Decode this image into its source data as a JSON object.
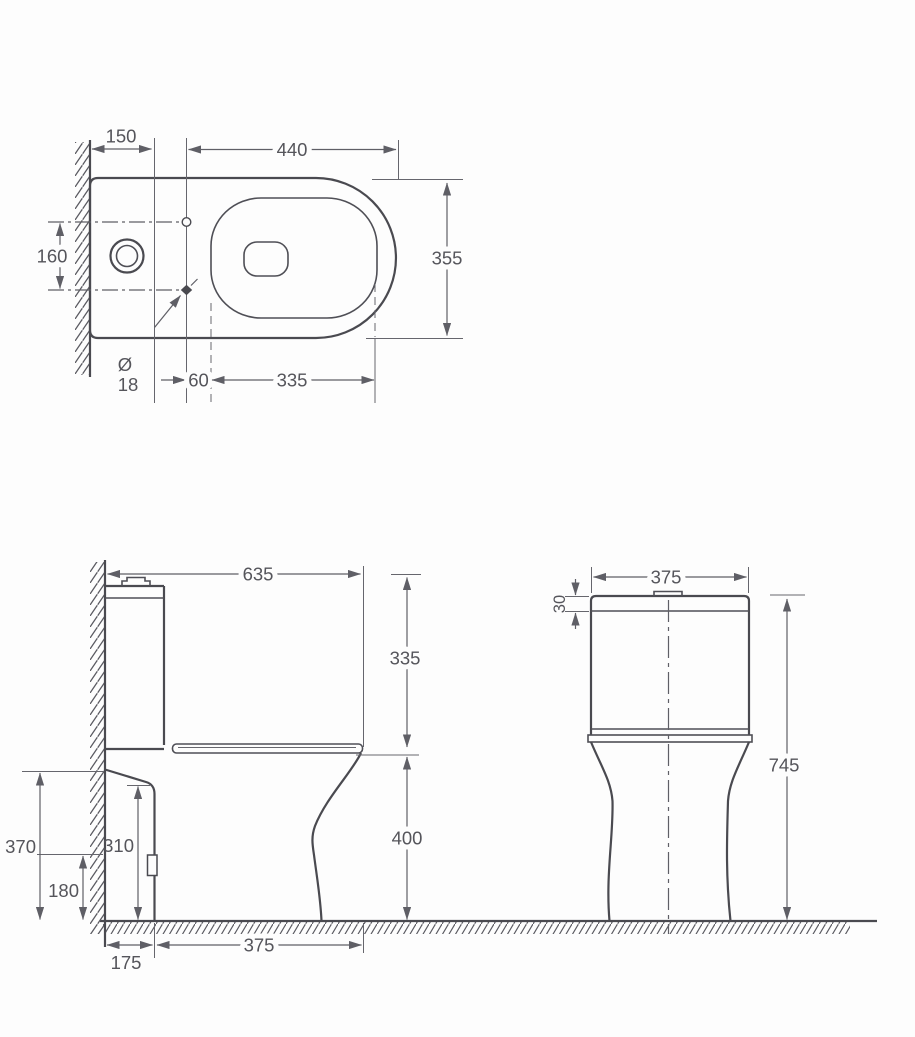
{
  "drawing_type": "toilet-technical-dimension-drawing",
  "colors": {
    "background": "#fdfdfd",
    "outline": "#4a4a50",
    "dimension": "#5f5f66",
    "text": "#55555b"
  },
  "dims": {
    "wall_to_holes": "150",
    "rim_length": "440",
    "rim_width": "355",
    "inlet_centres": "160",
    "hole_symbol": "Ø",
    "hole_size": "18",
    "holes_to_opening": "60",
    "opening_length": "335",
    "overall_depth": "635",
    "cistern_above_seat": "335",
    "seat_height": "400",
    "back_height": "370",
    "fixing_height": "310",
    "outlet_height": "180",
    "back_offset": "175",
    "seat_projection": "375",
    "cistern_width": "375",
    "lid_thickness": "30",
    "overall_height": "745"
  }
}
